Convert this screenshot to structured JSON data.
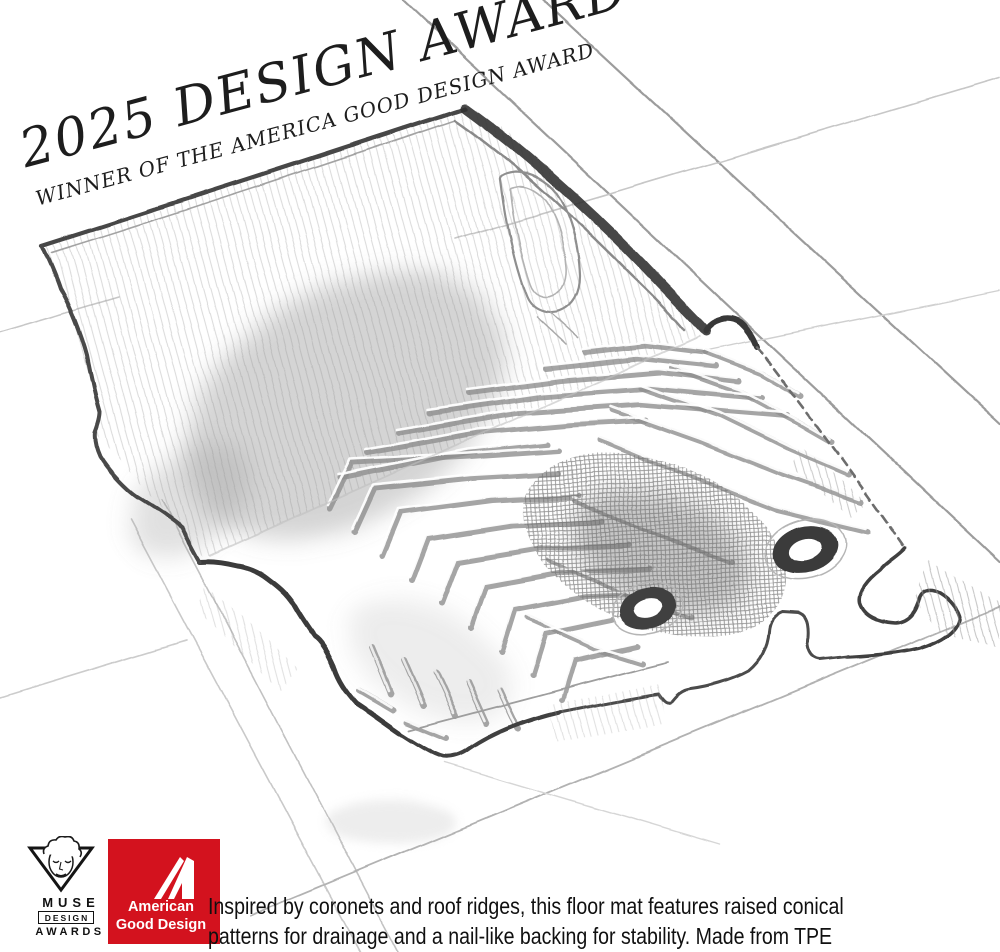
{
  "banner": {
    "title": "2025 DESIGN AWARD",
    "subtitle": "WINNER OF THE AMERICA GOOD DESIGN AWARD"
  },
  "description": {
    "line1": "Inspired by coronets and roof ridges, this floor mat features raised conical",
    "line2": "patterns for drainage and a nail-like backing for stability. Made from TPE"
  },
  "logos": {
    "muse": {
      "name": "MUSE",
      "line2": "DESIGN",
      "line3": "AWARDS"
    },
    "american_good_design": {
      "line1": "American",
      "line2": "Good Design",
      "accent_color": "#d3121e"
    }
  },
  "sketch": {
    "alt": "Pencil sketch of an automotive floor mat with raised herringbone ridge pattern, two fastener grommets and perspective grid lines"
  }
}
